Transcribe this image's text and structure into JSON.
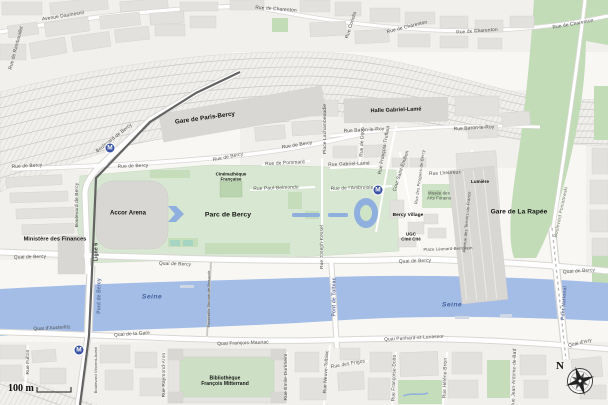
{
  "colors": {
    "land": "#f8f7f4",
    "zone": "#f2f0ed",
    "water": "#a3bde7",
    "wfeat": "#8fafdf",
    "park": "#d8e7d1",
    "parkdark": "#c6ddbc",
    "corridor": "#c2dcb7",
    "bld": "#e3e1de",
    "bldstroke": "#d1cfcc",
    "blddark": "#d9d7d4",
    "rail": "#f0efec",
    "track": "#c9c8c5",
    "casing": "#d9d7d4",
    "metro": "#3b53a5",
    "mline": "#636363",
    "lbl": "#4c4c4a",
    "lbldark": "#141414",
    "wlbl": "#5e6f9e",
    "sealbl": "#46619f",
    "glbl": "#6c7f63"
  },
  "metro_glyph": "M",
  "metro_icons": [
    {
      "x": 110,
      "y": 148
    },
    {
      "x": 378,
      "y": 190
    },
    {
      "x": 79,
      "y": 350
    }
  ],
  "scale": {
    "label": "100 m"
  },
  "compass": {
    "label": "N"
  },
  "labels": [
    {
      "t": "Avenue Daumesnil",
      "x": 63,
      "y": 16,
      "r": -9,
      "c": "st"
    },
    {
      "t": "Rue de Rambouillet",
      "x": 16,
      "y": 48,
      "r": -75,
      "c": "st"
    },
    {
      "t": "Rue de Charenton",
      "x": 276,
      "y": 9,
      "r": 4,
      "c": "st"
    },
    {
      "t": "Rue Coriolis",
      "x": 351,
      "y": 25,
      "r": -72,
      "c": "st"
    },
    {
      "t": "Rue de Charenton",
      "x": 407,
      "y": 27,
      "r": -14,
      "c": "st"
    },
    {
      "t": "Rue de Charenton",
      "x": 477,
      "y": 31,
      "r": -4,
      "c": "st"
    },
    {
      "t": "Rue de Charenton",
      "x": 573,
      "y": 24,
      "r": -10,
      "c": "st"
    },
    {
      "t": "Gare de Paris-Bercy",
      "x": 205,
      "y": 118,
      "r": -8,
      "c": "h1"
    },
    {
      "t": "Boulevard de Bercy",
      "x": 114,
      "y": 138,
      "r": -38,
      "c": "st"
    },
    {
      "t": "Boulevard de Bercy",
      "x": 77,
      "y": 205,
      "r": -90,
      "c": "st"
    },
    {
      "t": "Rue de Bercy",
      "x": 27,
      "y": 166,
      "r": -3,
      "c": "st"
    },
    {
      "t": "Rue de Bercy",
      "x": 133,
      "y": 166,
      "r": -2,
      "c": "st"
    },
    {
      "t": "Rue de Bercy",
      "x": 228,
      "y": 157,
      "r": -11,
      "c": "st"
    },
    {
      "t": "Rue de Bercy",
      "x": 297,
      "y": 145,
      "r": -9,
      "c": "st"
    },
    {
      "t": "Rue de Pommard",
      "x": 285,
      "y": 163,
      "r": -3,
      "c": "st"
    },
    {
      "t": "Rue Gabriel-Lamé",
      "x": 349,
      "y": 164,
      "r": -2,
      "c": "st"
    },
    {
      "t": "Rue Paul-Belmondo",
      "x": 276,
      "y": 188,
      "r": -2,
      "c": "st"
    },
    {
      "t": "Rue de l'Ambroisie",
      "x": 352,
      "y": 188,
      "r": -2,
      "c": "st"
    },
    {
      "t": "Rue Baron-le-Roy",
      "x": 364,
      "y": 130,
      "r": -3,
      "c": "st"
    },
    {
      "t": "Rue Baron-le-Roy",
      "x": 474,
      "y": 128,
      "r": -3,
      "c": "st"
    },
    {
      "t": "Place Lachambeaudie",
      "x": 325,
      "y": 129,
      "r": -90,
      "c": "st"
    },
    {
      "t": "Rue de Dijon",
      "x": 362,
      "y": 142,
      "r": -87,
      "c": "st"
    },
    {
      "t": "Rue François-Truffaut",
      "x": 384,
      "y": 150,
      "r": -80,
      "c": "st"
    },
    {
      "t": "Cour Saint-Émilion",
      "x": 401,
      "y": 171,
      "r": -72,
      "c": "st"
    },
    {
      "t": "Rue des Pirogues-de-Bercy",
      "x": 420,
      "y": 177,
      "r": -82,
      "c": "tiny",
      "s": 0.42
    },
    {
      "t": "Rue Lheureux",
      "x": 445,
      "y": 173,
      "r": -3,
      "c": "st"
    },
    {
      "t": "Avenue des Terroirs-de-France",
      "x": 467,
      "y": 222,
      "r": -85,
      "c": "tiny",
      "s": 0.42
    },
    {
      "t": "Rue Joseph-Kessel",
      "x": 322,
      "y": 247,
      "r": -90,
      "c": "st"
    },
    {
      "t": "Halle Gabriel-Lamé",
      "x": 396,
      "y": 110,
      "r": -2,
      "c": "h1",
      "s": 0.55
    },
    {
      "t": "Gare de La Rapée",
      "x": 519,
      "y": 212,
      "r": 0,
      "c": "h1",
      "s": 0.66
    },
    {
      "t": "Lumière",
      "x": 480,
      "y": 182,
      "r": 0,
      "c": "h2",
      "s": 0.46
    },
    {
      "t": "Bercy Village",
      "x": 408,
      "y": 215,
      "r": 0,
      "c": "h2",
      "s": 0.48
    },
    {
      "t": "UGC\nCiné Cité",
      "x": 411,
      "y": 237,
      "r": 0,
      "c": "h2",
      "s": 0.44
    },
    {
      "t": "Musée des\nArts Forains",
      "x": 439,
      "y": 196,
      "r": 0,
      "c": "tiny",
      "s": 0.42
    },
    {
      "t": "Place Léonard-Bernstein",
      "x": 448,
      "y": 249,
      "r": -2,
      "c": "tiny",
      "s": 0.42
    },
    {
      "t": "Boulevard Poniatowski",
      "x": 561,
      "y": 212,
      "r": -78,
      "c": "grn"
    },
    {
      "t": "Cinémathèque\nFrançaise",
      "x": 231,
      "y": 177,
      "r": 0,
      "c": "h2",
      "s": 0.44
    },
    {
      "t": "Parc de Bercy",
      "x": 228,
      "y": 215,
      "r": 0,
      "c": "h1",
      "s": 0.68
    },
    {
      "t": "Accor Arena",
      "x": 128,
      "y": 213,
      "r": 0,
      "c": "h1",
      "s": 0.6
    },
    {
      "t": "Ministère des Finances",
      "x": 55,
      "y": 239,
      "r": 0,
      "c": "h1",
      "s": 0.56
    },
    {
      "t": "Quai de Bercy",
      "x": 30,
      "y": 257,
      "r": -2,
      "c": "st"
    },
    {
      "t": "Quai de Bercy",
      "x": 175,
      "y": 264,
      "r": 2,
      "c": "st"
    },
    {
      "t": "Quai de Bercy",
      "x": 415,
      "y": 261,
      "r": -2,
      "c": "st"
    },
    {
      "t": "Quai de Bercy",
      "x": 579,
      "y": 271,
      "r": -4,
      "c": "st"
    },
    {
      "t": "Ligne 6",
      "x": 96,
      "y": 252,
      "r": -90,
      "c": "lg"
    },
    {
      "t": "Pont de Bercy",
      "x": 99,
      "y": 296,
      "r": -90,
      "c": "wa"
    },
    {
      "t": "Passerelle Simone-de-Beauvoir",
      "x": 209,
      "y": 299,
      "r": -90,
      "c": "tiny",
      "s": 0.38
    },
    {
      "t": "Pont de Tolbiac",
      "x": 334,
      "y": 297,
      "r": -90,
      "c": "wa"
    },
    {
      "t": "Pont National",
      "x": 564,
      "y": 303,
      "r": -86,
      "c": "wa"
    },
    {
      "t": "Seine",
      "x": 152,
      "y": 297,
      "r": 0,
      "c": "sea"
    },
    {
      "t": "Seine",
      "x": 452,
      "y": 305,
      "r": 0,
      "c": "sea"
    },
    {
      "t": "Quai d'Austerlitz",
      "x": 52,
      "y": 328,
      "r": -3,
      "c": "st"
    },
    {
      "t": "Quai de la Gare",
      "x": 132,
      "y": 334,
      "r": -4,
      "c": "st"
    },
    {
      "t": "Quai François-Mauriac",
      "x": 243,
      "y": 343,
      "r": -2,
      "c": "st"
    },
    {
      "t": "Quai Panhard-et-Levassor",
      "x": 414,
      "y": 338,
      "r": -3,
      "c": "st"
    },
    {
      "t": "Quai d'Ivry",
      "x": 580,
      "y": 343,
      "r": -14,
      "c": "st"
    },
    {
      "t": "Rue Fulton",
      "x": 28,
      "y": 362,
      "r": -90,
      "c": "st"
    },
    {
      "t": "Boulevard Vincent-Auriol",
      "x": 96,
      "y": 370,
      "r": -90,
      "c": "tiny",
      "s": 0.4
    },
    {
      "t": "Rue Raymond-Aron",
      "x": 164,
      "y": 375,
      "r": -90,
      "c": "st"
    },
    {
      "t": "Bibliothèque\nFrançois Mitterrand",
      "x": 225,
      "y": 381,
      "r": 0,
      "c": "h2",
      "s": 0.5
    },
    {
      "t": "Rue Émile-Durkheim",
      "x": 286,
      "y": 377,
      "r": -90,
      "c": "st"
    },
    {
      "t": "Rue Neuve-Tolbiac",
      "x": 326,
      "y": 372,
      "r": -87,
      "c": "st"
    },
    {
      "t": "Rue des Frigos",
      "x": 348,
      "y": 364,
      "r": -10,
      "c": "st"
    },
    {
      "t": "Rue Françoise-Dolto",
      "x": 394,
      "y": 378,
      "r": -88,
      "c": "st"
    },
    {
      "t": "Rue Hélène-Brion",
      "x": 445,
      "y": 378,
      "r": -88,
      "c": "st"
    },
    {
      "t": "Rue Jean-Antoine-de-Baïf",
      "x": 514,
      "y": 378,
      "r": -88,
      "c": "st"
    }
  ]
}
